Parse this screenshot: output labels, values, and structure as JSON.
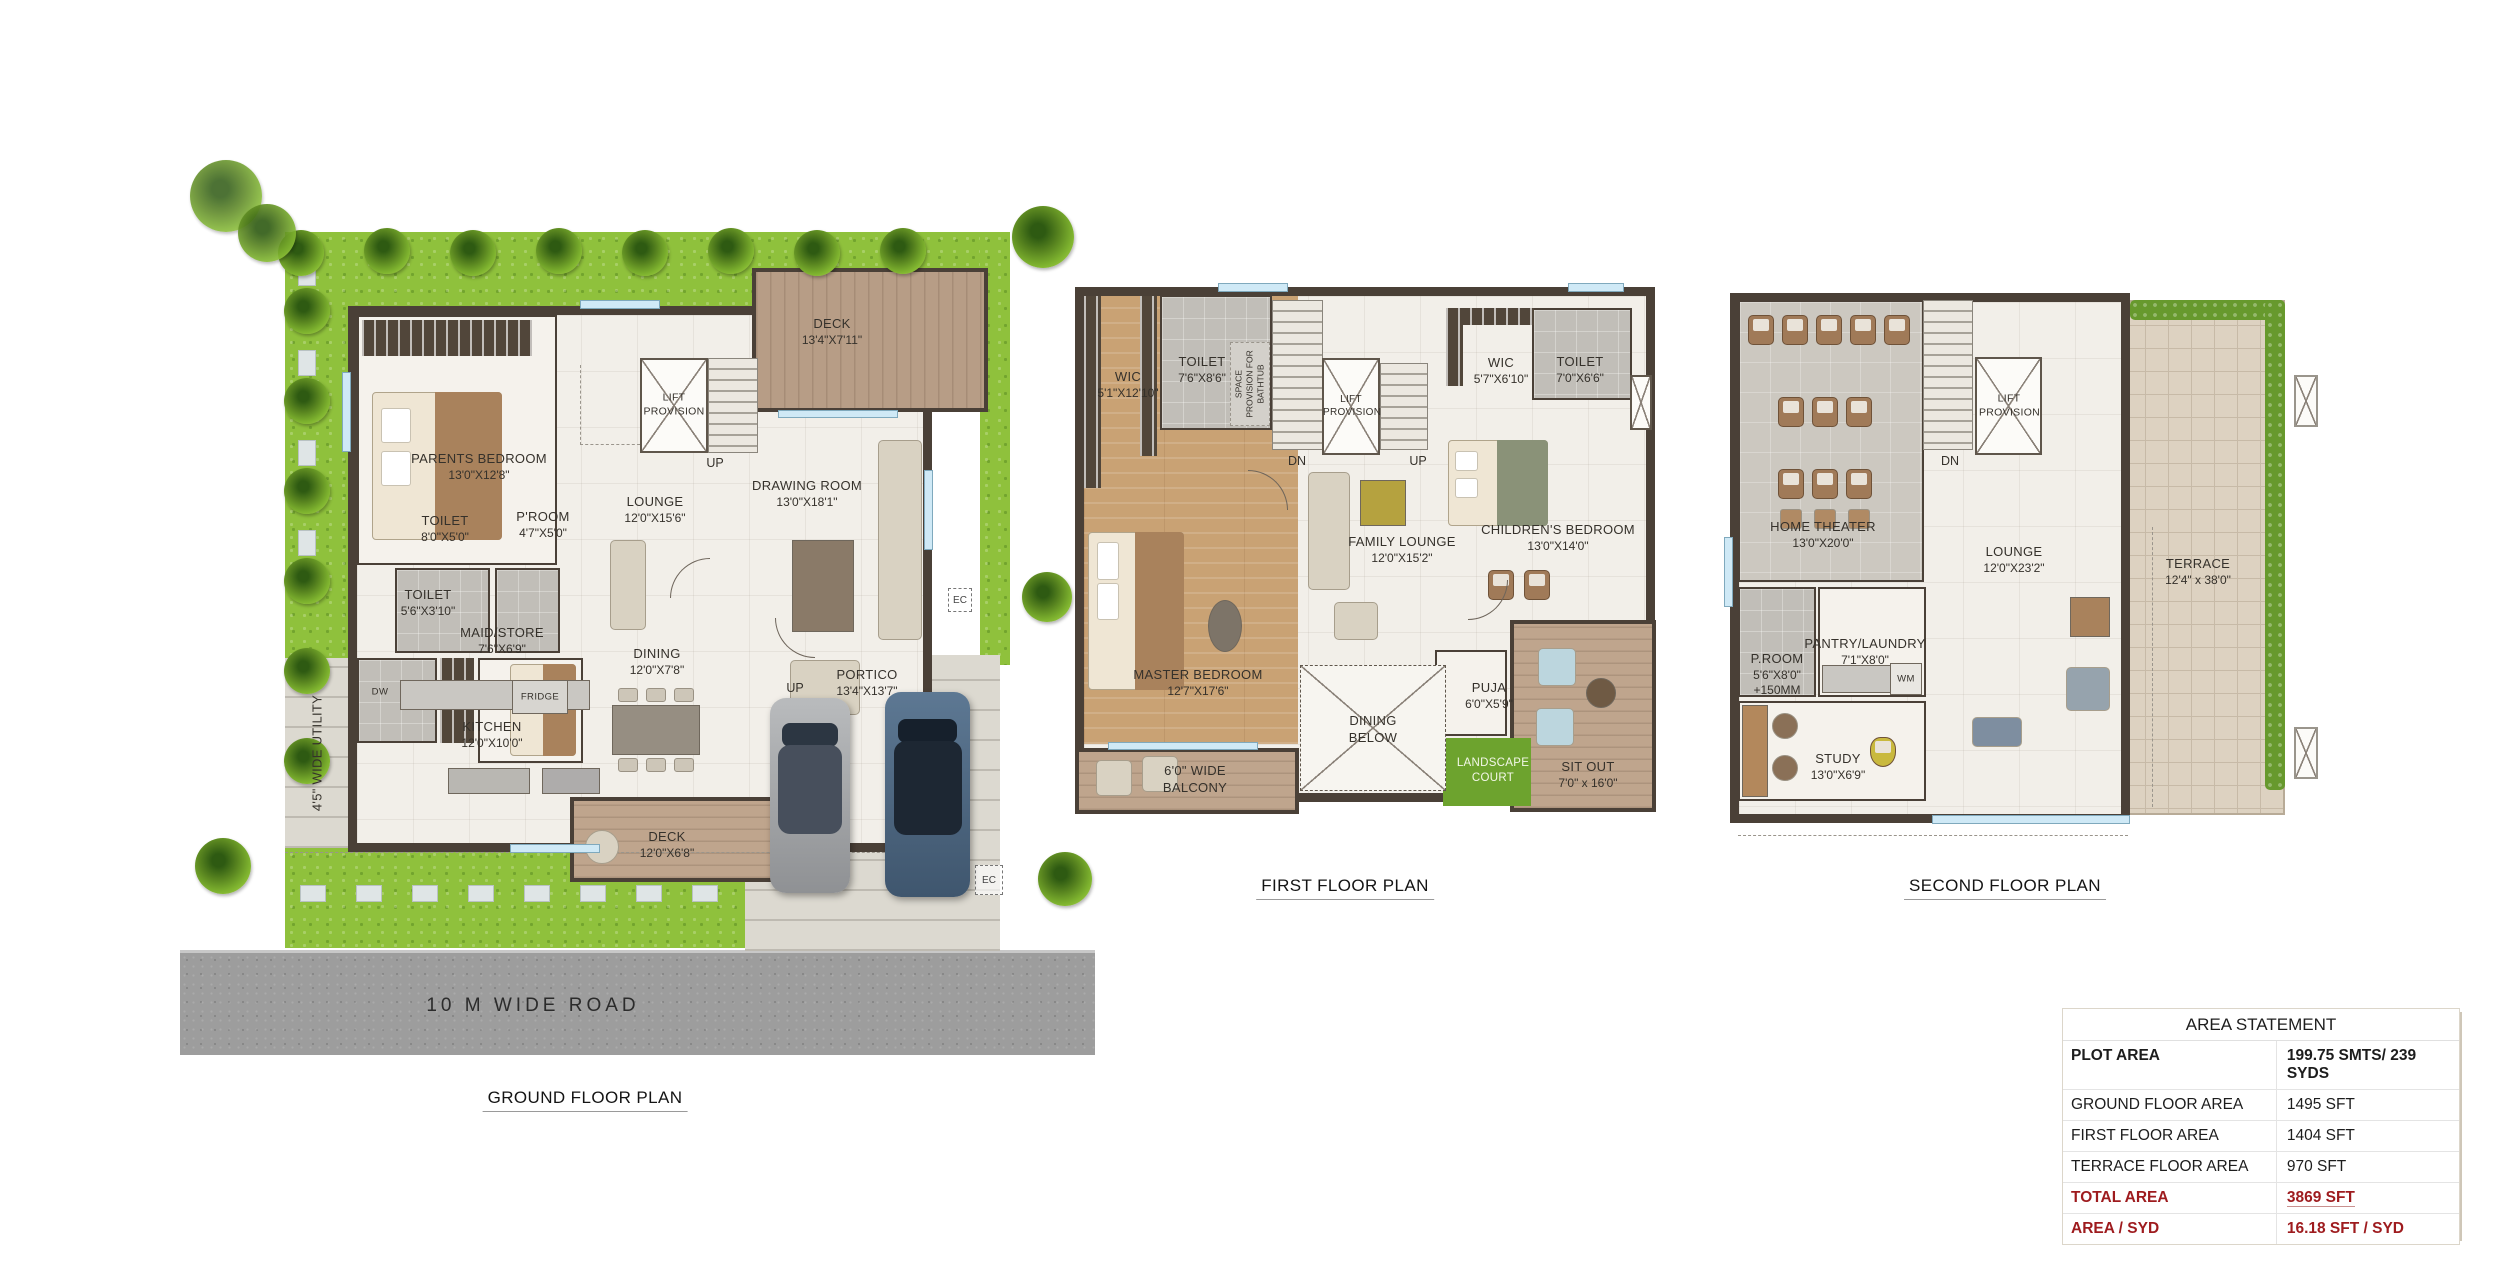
{
  "plan_titles": {
    "ground": "GROUND FLOOR PLAN",
    "first": "FIRST FLOOR PLAN",
    "second": "SECOND FLOOR PLAN"
  },
  "road_label": "10 M WIDE ROAD",
  "markers": {
    "up": "UP",
    "dn": "DN",
    "ec": "EC",
    "wm": "WM",
    "dw": "DW",
    "fridge": "FRIDGE"
  },
  "ground": {
    "parents_bedroom": {
      "name": "PARENTS BEDROOM",
      "dims": "13'0\"X12'8\""
    },
    "toilet_top": {
      "name": "TOILET",
      "dims": "8'0\"X5'0\""
    },
    "p_room": {
      "name": "P'ROOM",
      "dims": "4'7\"X5'0\""
    },
    "toilet_left": {
      "name": "TOILET",
      "dims": "5'6\"X3'10\""
    },
    "maid_store": {
      "name": "MAID/STORE",
      "dims": "7'6\"X6'9\""
    },
    "lounge": {
      "name": "LOUNGE",
      "dims": "12'0\"X15'6\""
    },
    "lift": {
      "name": "LIFT PROVISION"
    },
    "drawing_room": {
      "name": "DRAWING ROOM",
      "dims": "13'0\"X18'1\""
    },
    "deck_top": {
      "name": "DECK",
      "dims": "13'4\"X7'11\""
    },
    "dining": {
      "name": "DINING",
      "dims": "12'0\"X7'8\""
    },
    "kitchen": {
      "name": "KITCHEN",
      "dims": "12'0\"X10'0\""
    },
    "deck_bottom": {
      "name": "DECK",
      "dims": "12'0\"X6'8\""
    },
    "portico": {
      "name": "PORTICO",
      "dims": "13'4\"X13'7\""
    },
    "utility": {
      "name": "4'5\" WIDE UTILITY"
    }
  },
  "first": {
    "wic_left": {
      "name": "WIC",
      "dims": "5'1\"X12'10\""
    },
    "toilet_left": {
      "name": "TOILET",
      "dims": "7'6\"X8'6\""
    },
    "bathtub_note": {
      "name": "SPACE PROVISION FOR BATHTUB"
    },
    "lift": {
      "name": "LIFT PROVISION"
    },
    "wic_right": {
      "name": "WIC",
      "dims": "5'7\"X6'10\""
    },
    "toilet_right": {
      "name": "TOILET",
      "dims": "7'0\"X6'6\""
    },
    "childrens_bedroom": {
      "name": "CHILDREN'S BEDROOM",
      "dims": "13'0\"X14'0\""
    },
    "family_lounge": {
      "name": "FAMILY LOUNGE",
      "dims": "12'0\"X15'2\""
    },
    "master_bedroom": {
      "name": "MASTER BEDROOM",
      "dims": "12'7\"X17'6\""
    },
    "balcony": {
      "name": "6'0\" WIDE BALCONY"
    },
    "dining_below": {
      "name": "DINING BELOW"
    },
    "puja": {
      "name": "PUJA",
      "dims": "6'0\"X5'9\""
    },
    "landscape_court": {
      "name": "LANDSCAPE COURT"
    },
    "sit_out": {
      "name": "SIT OUT",
      "dims": "7'0\" x 16'0\""
    }
  },
  "second": {
    "home_theater": {
      "name": "HOME THEATER",
      "dims": "13'0\"X20'0\""
    },
    "lift": {
      "name": "LIFT PROVISION"
    },
    "lounge": {
      "name": "LOUNGE",
      "dims": "12'0\"X23'2\""
    },
    "p_room": {
      "name": "P.ROOM",
      "dims": "5'6\"X8'0\"",
      "note": "+150MM"
    },
    "pantry_laundry": {
      "name": "PANTRY/LAUNDRY",
      "dims": "7'1\"X8'0\""
    },
    "study": {
      "name": "STUDY",
      "dims": "13'0\"X6'9\""
    },
    "terrace": {
      "name": "TERRACE",
      "dims": "12'4\" x 38'0\""
    }
  },
  "area_statement": {
    "title": "AREA STATEMENT",
    "rows": [
      {
        "label": "PLOT AREA",
        "value": "199.75 SMTS/ 239 SYDS"
      },
      {
        "label": "GROUND FLOOR AREA",
        "value": "1495 SFT"
      },
      {
        "label": "FIRST FLOOR AREA",
        "value": "1404 SFT"
      },
      {
        "label": "TERRACE FLOOR AREA",
        "value": "970 SFT"
      },
      {
        "label": "TOTAL  AREA",
        "value": "3869 SFT"
      },
      {
        "label": "AREA / SYD",
        "value": "16.18 SFT / SYD"
      }
    ]
  },
  "colors": {
    "wall": "#4a4037",
    "grass": "#8fc13c",
    "wood": "#c9a274",
    "deck": "#b79d86",
    "road": "#9d9d9d",
    "highlight_red": "#9e1b1e"
  }
}
